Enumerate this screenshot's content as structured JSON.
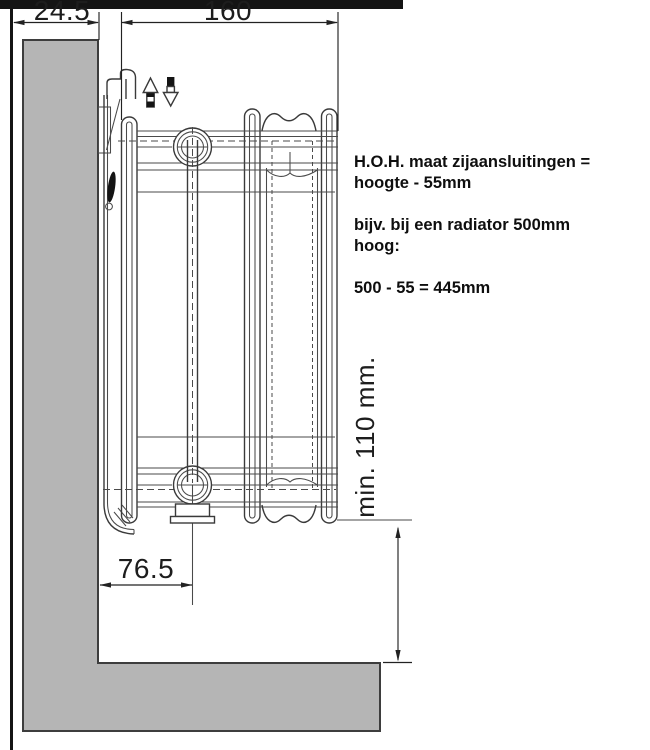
{
  "colors": {
    "wall_fill": "#b5b5b5",
    "wall_outline": "#3d3d3d",
    "drawing_line": "#3a3a3a",
    "dimension_line": "#222222",
    "border_black": "#151515"
  },
  "dimensions": {
    "bracket_offset": "24.5",
    "radiator_depth": "160",
    "connection_center_from_wall": "76.5",
    "min_floor_clearance": "min. 110 mm."
  },
  "annotation": {
    "line1": "H.O.H. maat zijaansluitingen =",
    "line2": "hoogte - 55mm",
    "line3": "bijv. bij een radiator 500mm",
    "line4": "hoog:",
    "line5": "500 - 55 = 445mm"
  }
}
